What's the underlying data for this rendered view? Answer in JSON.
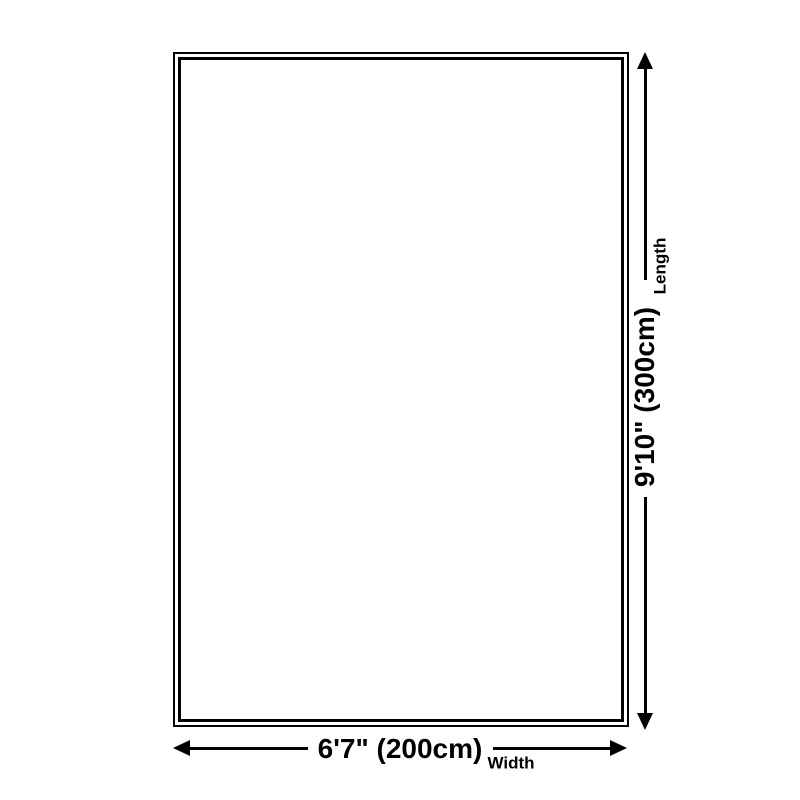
{
  "page": {
    "background_color": "#ffffff",
    "ink_color": "#000000"
  },
  "dimensions": {
    "length": {
      "value": "9'10\" (300cm)",
      "label": "Length"
    },
    "width": {
      "value": "6'7\" (200cm)",
      "label": "Width"
    }
  }
}
